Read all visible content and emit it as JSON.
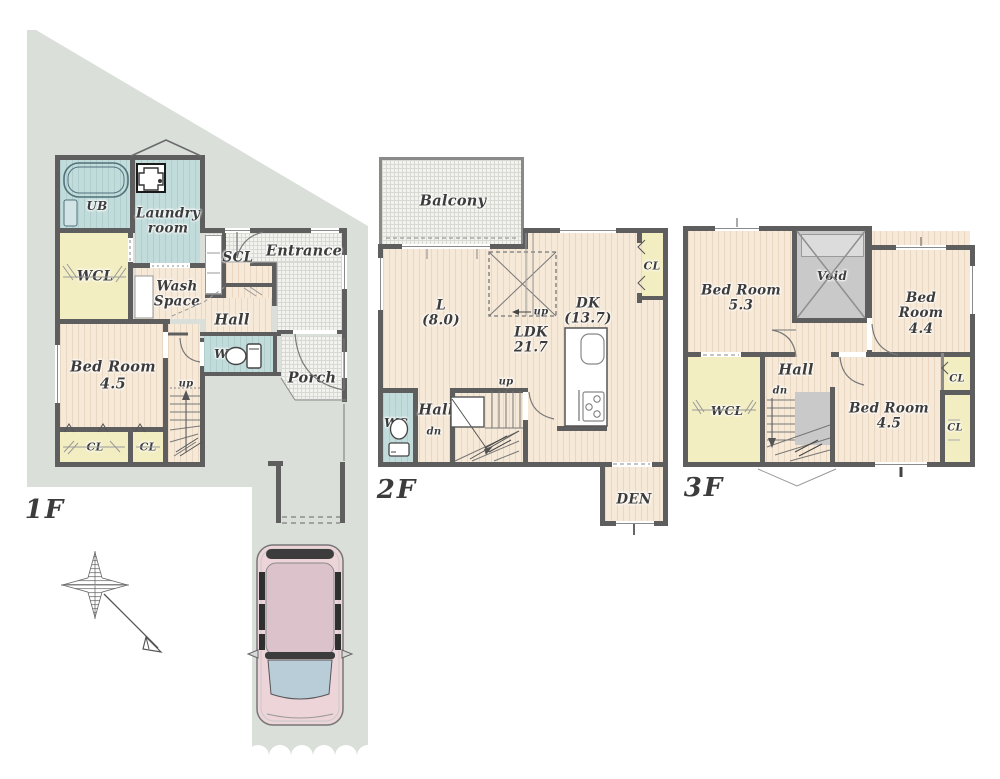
{
  "palette": {
    "site_green_gray": "#dadfda",
    "wall": "#5e5e5e",
    "wood_floor": "#f6e9d8",
    "wet_area_teal": "#c2dbdb",
    "closet_yellow": "#f3eec2",
    "tile_hatch": "#f2f2ef",
    "void_gray": "#c9c9c9",
    "label_text": "#3c3c3c",
    "car_body_pink": "#ecd4d9",
    "car_glass_blue": "#b9cdd9"
  },
  "floors": {
    "f1": {
      "title": "1F",
      "rooms": {
        "ub": "UB",
        "laundry": "Laundry\nroom",
        "wcl": "WCL",
        "wash": "Wash\nSpace",
        "scl": "SCL",
        "entrance": "Entrance",
        "hall": "Hall",
        "wc": "WC",
        "porch": "Porch",
        "bedroom": "Bed Room\n4.5",
        "cl_left": "CL",
        "cl_right": "CL",
        "up": "up"
      }
    },
    "f2": {
      "title": "2F",
      "rooms": {
        "balcony": "Balcony",
        "living": "L\n(8.0)",
        "ldk": "LDK\n21.7",
        "dk": "DK\n(13.7)",
        "cl": "CL",
        "up_void": "up",
        "up_stairs": "up",
        "dn": "dn",
        "wc": "WC",
        "hall": "Hall",
        "den": "DEN"
      }
    },
    "f3": {
      "title": "3F",
      "rooms": {
        "bedroom_53": "Bed Room\n5.3",
        "void": "Void",
        "bedroom_44": "Bed Room\n4.4",
        "hall": "Hall",
        "wcl": "WCL",
        "dn": "dn",
        "bedroom_45": "Bed Room\n4.5",
        "cl_top": "CL",
        "cl_bottom": "CL"
      }
    }
  }
}
